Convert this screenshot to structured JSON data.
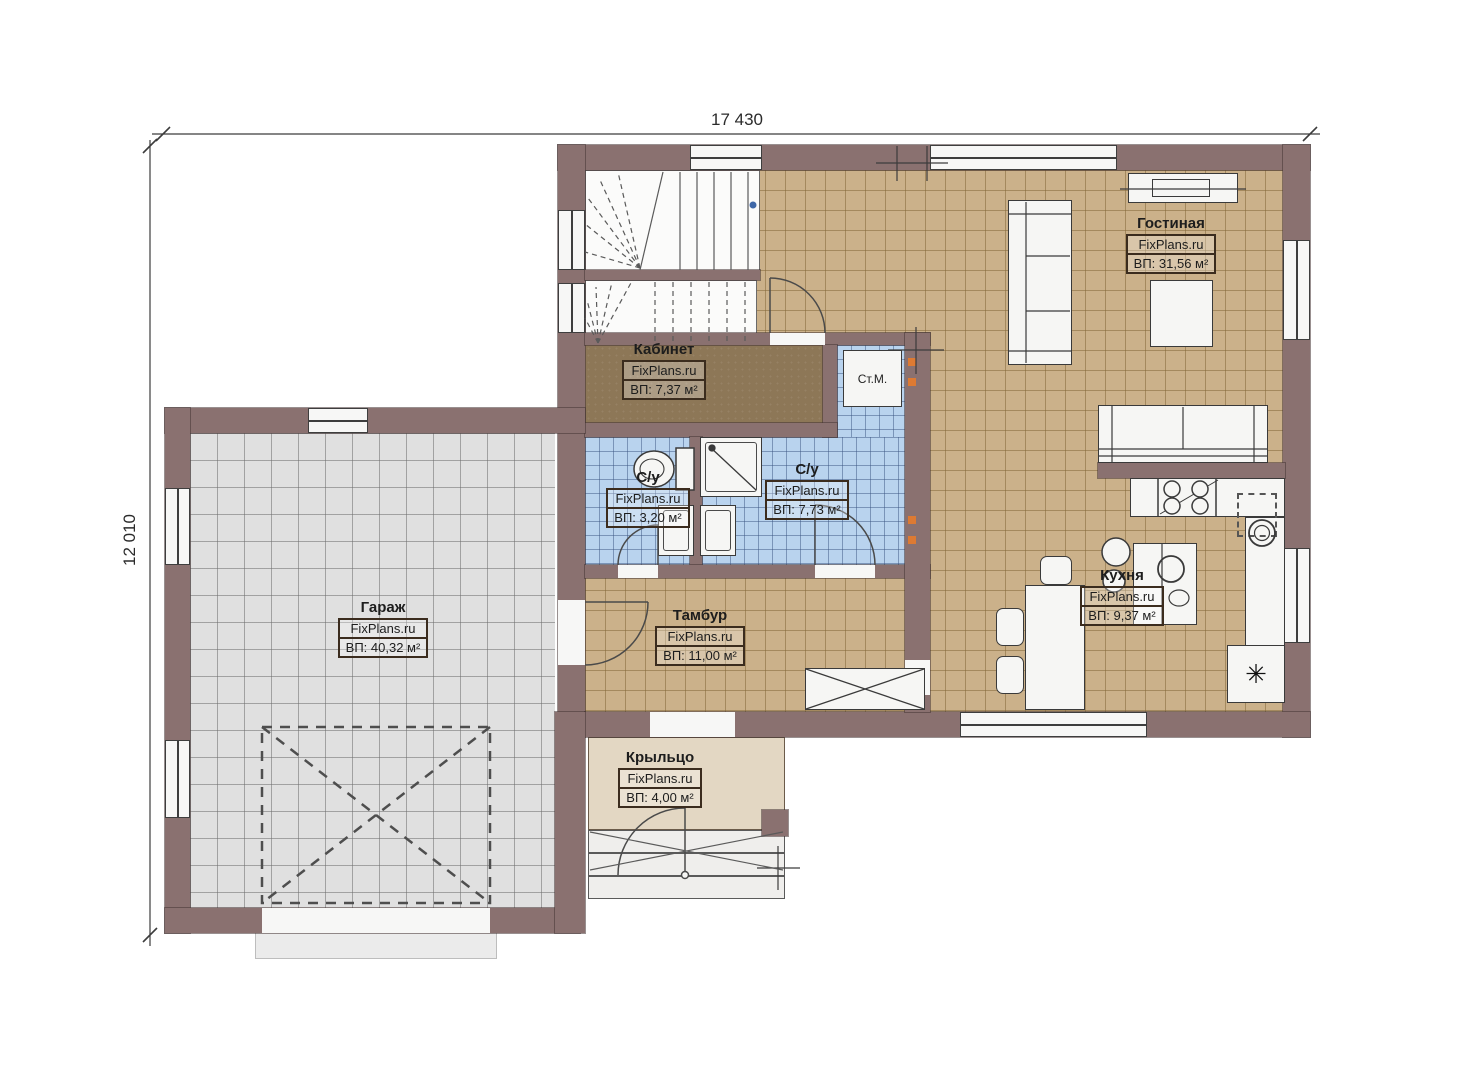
{
  "branding": "FixPlans.ru",
  "dimensions": {
    "width_label": "17 430",
    "height_label": "12 010"
  },
  "rooms": [
    {
      "key": "living",
      "name": "Гостиная",
      "area": "ВП: 31,56 м²"
    },
    {
      "key": "office",
      "name": "Кабинет",
      "area": "ВП: 7,37 м²"
    },
    {
      "key": "bath-small",
      "name": "С/у",
      "area": "ВП: 3,20 м²"
    },
    {
      "key": "bath-big",
      "name": "С/у",
      "area": "ВП: 7,73 м²"
    },
    {
      "key": "vestibule",
      "name": "Тамбур",
      "area": "ВП: 11,00 м²"
    },
    {
      "key": "kitchen",
      "name": "Кухня",
      "area": "ВП: 9,37 м²"
    },
    {
      "key": "garage",
      "name": "Гараж",
      "area": "ВП: 40,32 м²"
    },
    {
      "key": "porch",
      "name": "Крыльцо",
      "area": "ВП: 4,00 м²"
    }
  ],
  "fixtures": {
    "washing_machine_label": "Ст.М.",
    "fridge_symbol": "✳"
  },
  "colors": {
    "wall": "#8a7170",
    "floor_main": "#cbb18a",
    "floor_tile": "#b9d3ee",
    "floor_garage": "#e0e0e0",
    "floor_office": "#8d7757",
    "floor_porch": "#e3d7c3",
    "vent_accent": "#dd7a33",
    "stair_marker": "#3f68a8"
  }
}
